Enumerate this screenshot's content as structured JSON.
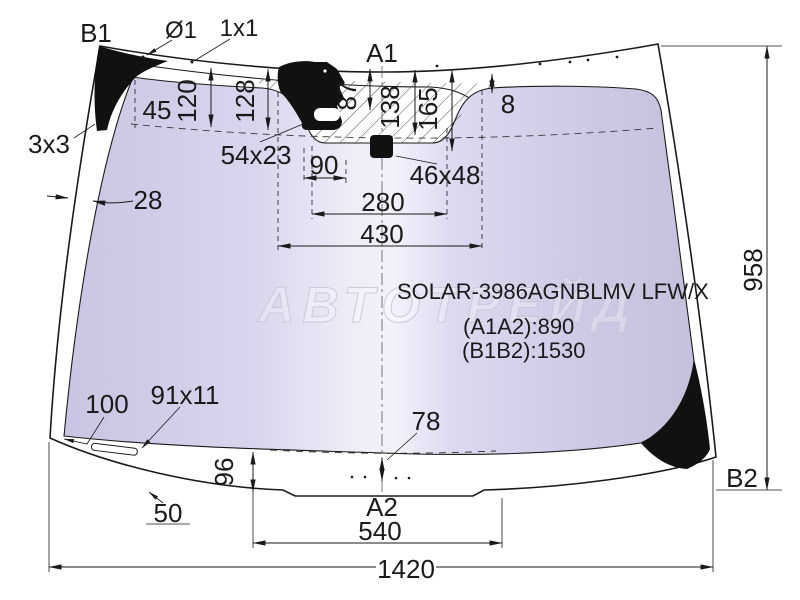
{
  "part": {
    "code": "SOLAR-3986AGNBLMV LFW/X",
    "dim_a1a2": "(A1A2):890",
    "dim_b1b2": "(B1B2):1530"
  },
  "watermark": {
    "text": "АВТОТРЕЙД"
  },
  "ref_points": {
    "b1": "B1",
    "a1": "A1",
    "a2": "A2",
    "b2": "B2"
  },
  "dimensions": {
    "hole_dia": "Ø1",
    "tick": "1x1",
    "edge": "3x3",
    "d45": "45",
    "d120": "120",
    "d128": "128",
    "d87": "87",
    "d138": "138",
    "d165": "165",
    "d8": "8",
    "bracket_slot": "54x23",
    "d90": "90",
    "sensor": "46x48",
    "d28": "28",
    "d280": "280",
    "d430": "430",
    "height": "958",
    "d100": "100",
    "strip": "91x11",
    "d96": "96",
    "d50": "50",
    "d78": "78",
    "d540": "540",
    "width": "1420"
  },
  "colors": {
    "background": "#ffffff",
    "line": "#1a1a1a",
    "glass_tint": "#d6d2ec",
    "glass_highlight": "#f3f2fb",
    "black_patch": "#111111",
    "watermark": "#c7c7d4"
  }
}
